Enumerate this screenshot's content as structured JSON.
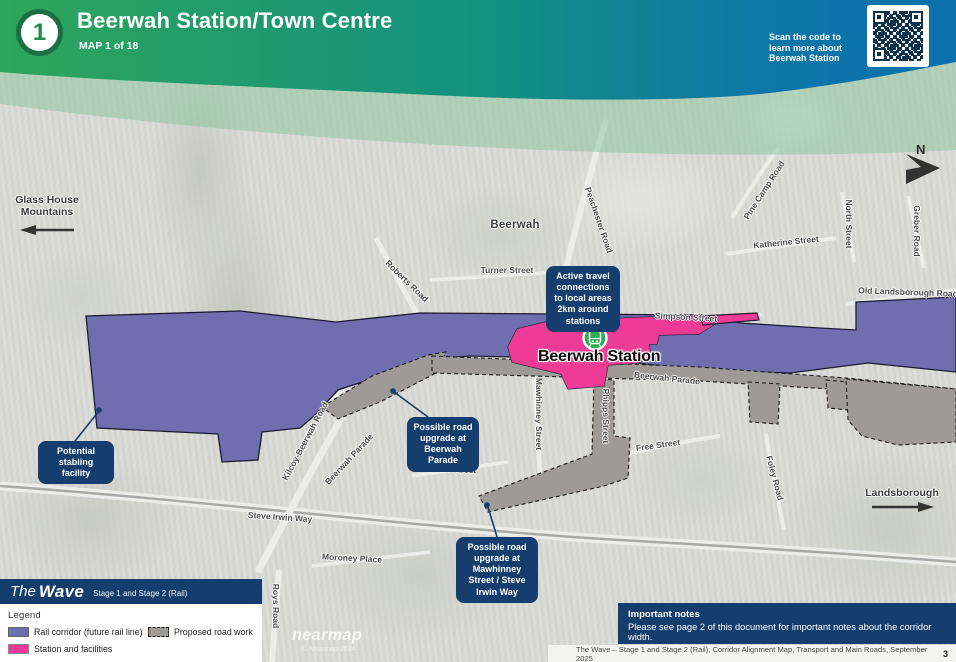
{
  "colors": {
    "header-green": "#2ea55b",
    "header-teal": "#13917f",
    "header-blue": "#0c70ad",
    "navy": "#153d6d",
    "purple": "#716eb0",
    "pink": "#ee3b95",
    "roadwork": "#9d9a97",
    "map-bg": "#dadad7",
    "tint": "#86c496",
    "label": "#4c4c4f",
    "qr-ink": "#0d3350"
  },
  "header": {
    "badge": "1",
    "title": "Beerwah Station/Town Centre",
    "subtitle": "MAP 1 of 18",
    "qr_caption": "Scan the code to learn more about Beerwah Station"
  },
  "map": {
    "town": "Beerwah",
    "station_name": "Beerwah Station",
    "north": "N",
    "direction_west": "Glass House Mountains",
    "direction_east": "Landsborough",
    "street_labels": [
      {
        "text": "Turner Street"
      },
      {
        "text": "Simpson Street"
      },
      {
        "text": "Old Landsborough Road"
      },
      {
        "text": "Pine Camp Road"
      },
      {
        "text": "Katherine Street"
      },
      {
        "text": "North Street"
      },
      {
        "text": "Greber Road"
      },
      {
        "text": "Peachester Road"
      },
      {
        "text": "Roberts Road"
      },
      {
        "text": "Kilcoy-Beerwah Road"
      },
      {
        "text": "Beerwah Parade"
      },
      {
        "text": "Beerwah Parade"
      },
      {
        "text": "Mawhinney Street"
      },
      {
        "text": "Phipps Street"
      },
      {
        "text": "Free Street"
      },
      {
        "text": "Foley Road"
      },
      {
        "text": "Swan Street"
      },
      {
        "text": "Steve Irwin Way"
      },
      {
        "text": "Moroney Place"
      },
      {
        "text": "Roys Road"
      }
    ],
    "callouts": [
      {
        "text": "Active travel connections to local areas 2km around stations"
      },
      {
        "text": "Potential stabling facility"
      },
      {
        "text": "Possible road upgrade at Beerwah Parade"
      },
      {
        "text": "Possible road upgrade at Mawhinney Street / Steve Irwin Way"
      }
    ],
    "watermark_brand": "nearmap",
    "watermark_copyright": "© Nearmap 2024"
  },
  "legend": {
    "brand_the": "The",
    "brand_wave": "Wave",
    "brand_stage": "Stage 1 and Stage 2 (Rail)",
    "title": "Legend",
    "items": [
      {
        "label": "Rail corridor (future rail line)"
      },
      {
        "label": "Proposed road work"
      },
      {
        "label": "Station and facilities"
      }
    ]
  },
  "notes": {
    "title": "Important notes",
    "body": "Please see page 2 of this document for important notes about the corridor width."
  },
  "footer": {
    "text": "The Wave – Stage 1 and Stage 2 (Rail), Corridor Alignment Map, Transport and Main Roads, September 2025",
    "page": "3"
  }
}
